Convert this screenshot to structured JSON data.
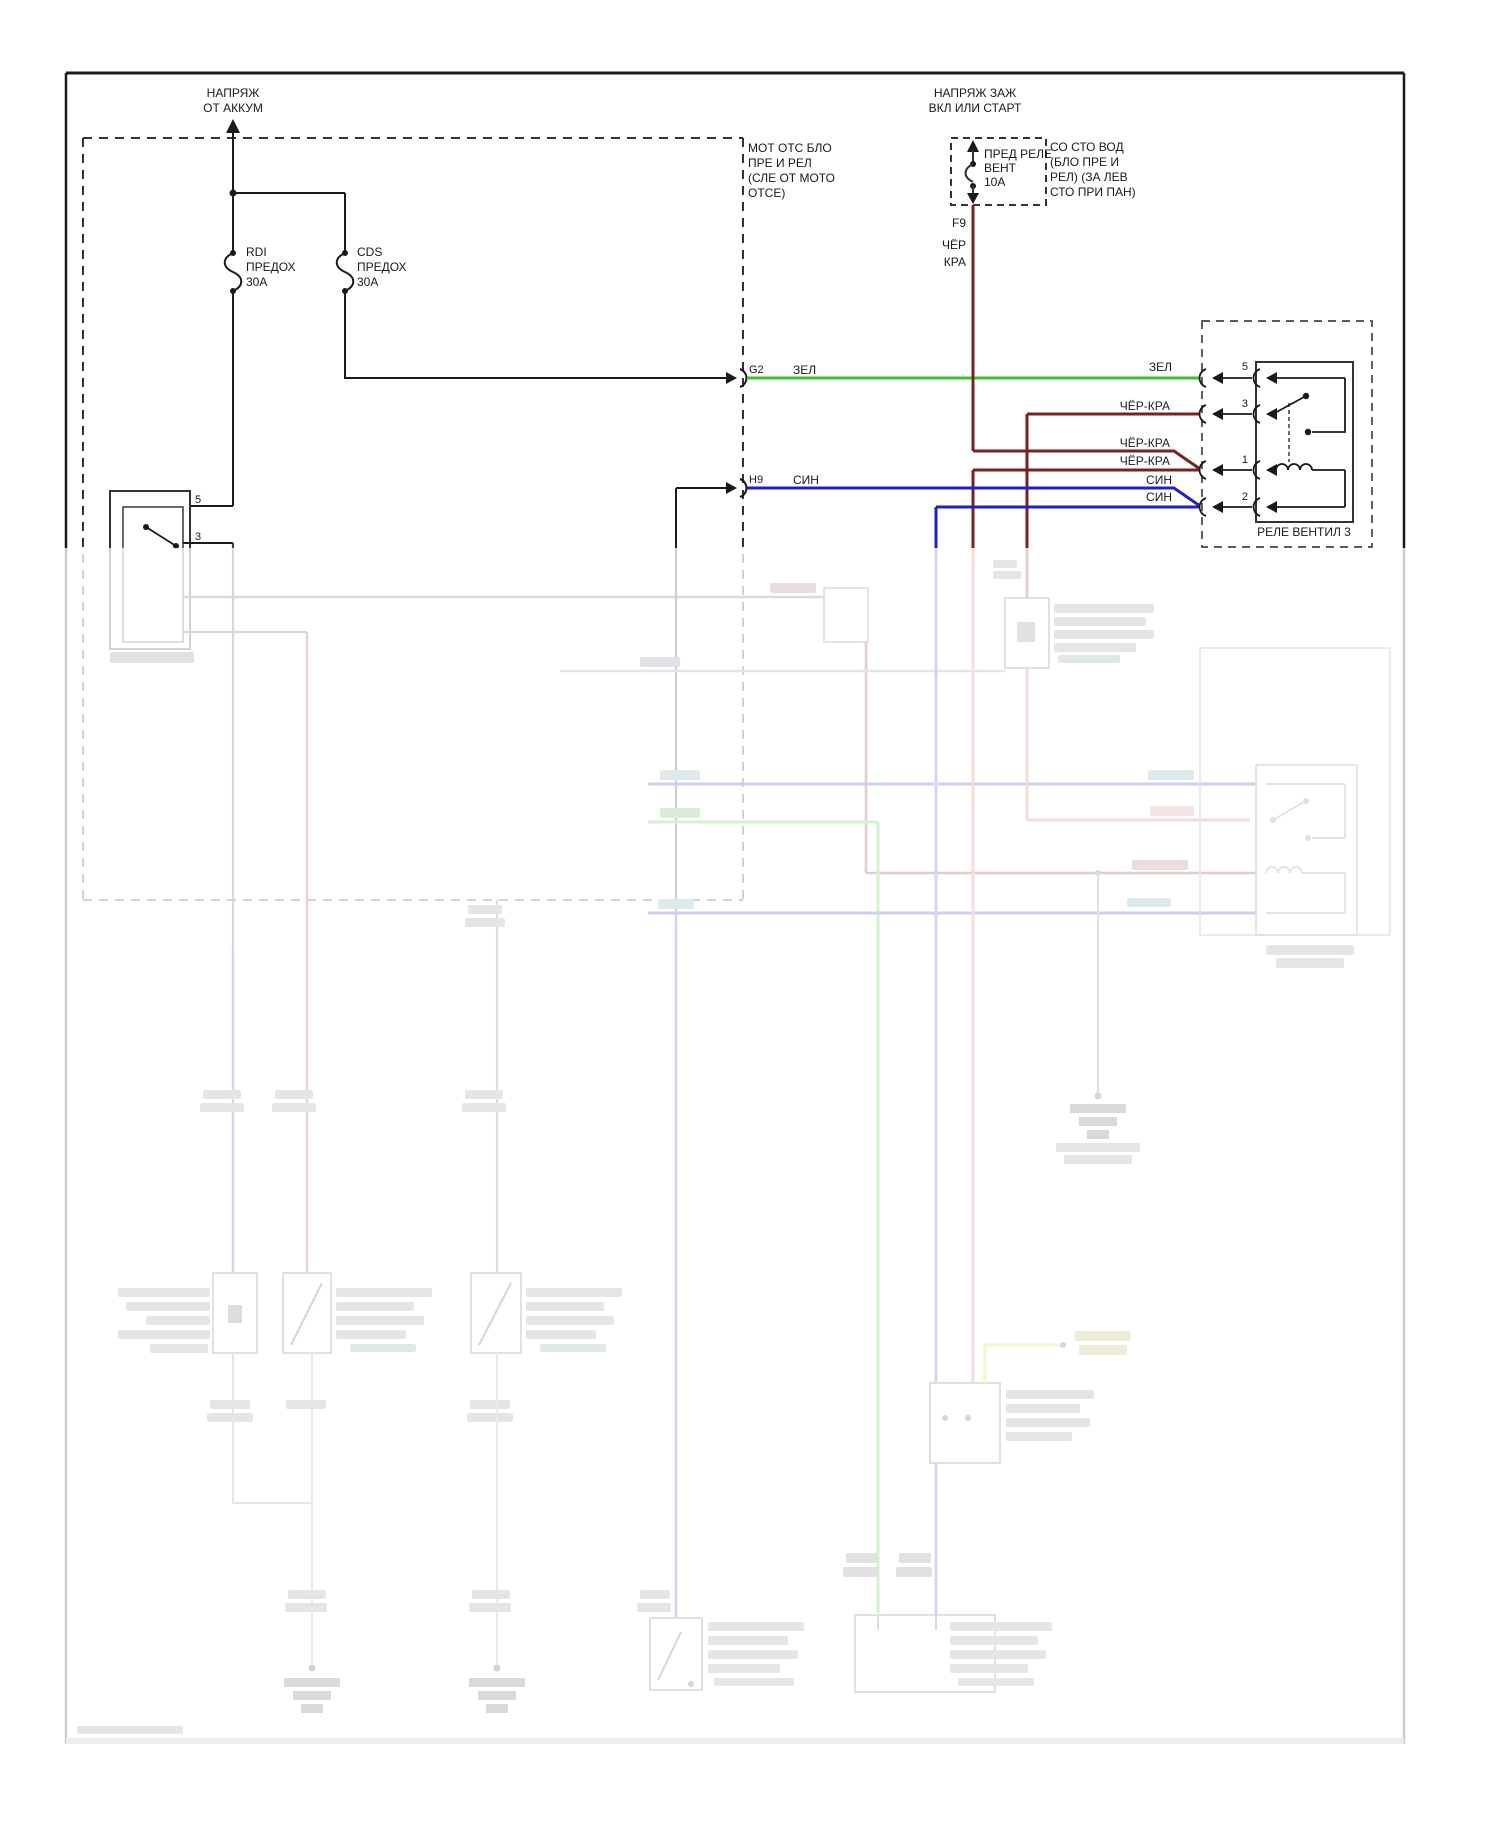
{
  "diagram_title": "Cooling fan wiring diagram (Russian)",
  "colors": {
    "wire_green": "#3fbe2e",
    "wire_blue": "#2121c0",
    "wire_dark_red": "#7a2121",
    "wire_red_faded": "#dd5555",
    "wire_yellow": "#d6d62a",
    "line_black": "#1a1a1a",
    "faded_gray": "#777777"
  },
  "battery_feed": {
    "title": "НАПРЯЖ\nОТ АККУМ"
  },
  "ignition_feed": {
    "title": "НАПРЯЖ ЗАЖ\nВКЛ ИЛИ СТАРТ"
  },
  "fuses": {
    "rdi": "RDI\nПРЕДОХ\n30A",
    "cds": "CDS\nПРЕДОХ\n30A",
    "fan_relay_fuse": "ПРЕД РЕЛЕ\nВЕНТ\n10A",
    "f9": "F9"
  },
  "blocks": {
    "engine_junction_block": "МОТ ОТС БЛО\nПРЕ И РЕЛ\n(СЛЕ ОТ МОТО\nОТСЕ)",
    "driver_junction_block": "СО СТО ВОД\n(БЛО ПРЕ И\nРЕЛ) (ЗА ЛЕВ\nСТО ПРИ ПАН)"
  },
  "connectors": {
    "g2": "G2",
    "h9": "H9"
  },
  "wire_labels": {
    "cher": "ЧЁР",
    "kra": "КРА",
    "zel_left": "ЗЕЛ",
    "zel_right": "ЗЕЛ",
    "sin_h9": "СИН",
    "cher_kra_pin3": "ЧЁР-КРА",
    "cher_kra_pin1_a": "ЧЁР-КРА",
    "cher_kra_pin1_b": "ЧЁР-КРА",
    "sin_pin2_a": "СИН",
    "sin_pin2_b": "СИН"
  },
  "relay3": {
    "name": "РЕЛЕ ВЕНТИЛ 3",
    "pin5": "5",
    "pin3": "3",
    "pin1": "1",
    "pin2": "2"
  },
  "relay1": {
    "pin5": "5",
    "pin3": "3"
  }
}
